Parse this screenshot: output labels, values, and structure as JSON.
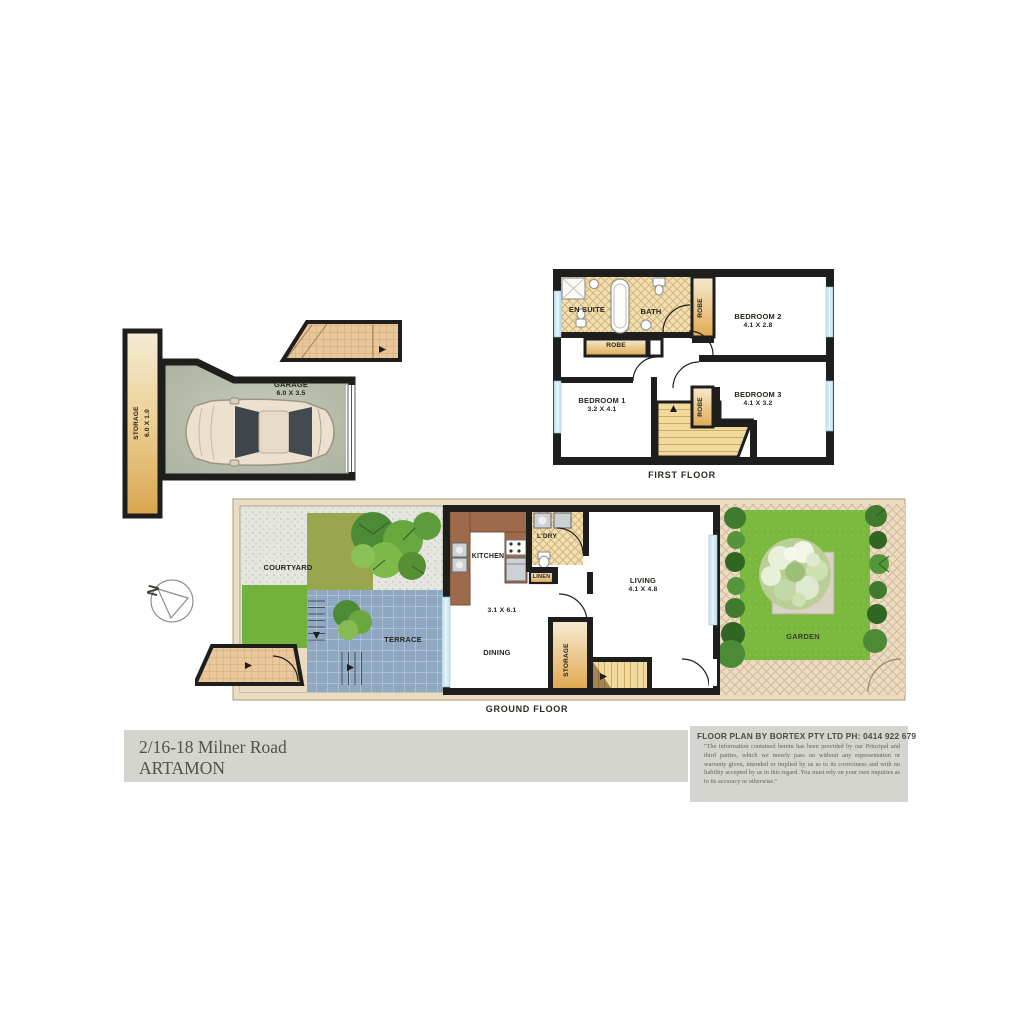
{
  "first_floor": {
    "caption": "FIRST FLOOR",
    "rooms": {
      "en_suite": {
        "label": "EN SUITE"
      },
      "bath": {
        "label": "BATH"
      },
      "robe_top": {
        "label": "ROBE"
      },
      "robe_hall": {
        "label": "ROBE"
      },
      "robe_mid": {
        "label": "ROBE"
      },
      "bedroom2": {
        "label": "BEDROOM 2",
        "dims": "4.1 X 2.8"
      },
      "bedroom1": {
        "label": "BEDROOM 1",
        "dims": "3.2 X 4.1"
      },
      "bedroom3": {
        "label": "BEDROOM 3",
        "dims": "4.1 X 3.2"
      }
    }
  },
  "garage_block": {
    "garage": {
      "label": "GARAGE",
      "dims": "6.0 X 3.5"
    },
    "storage": {
      "label": "STORAGE",
      "dims": "6.0 X 1.0"
    }
  },
  "ground_floor": {
    "caption": "GROUND FLOOR",
    "rooms": {
      "courtyard": {
        "label": "COURTYARD"
      },
      "terrace": {
        "label": "TERRACE"
      },
      "kitchen": {
        "label": "KITCHEN"
      },
      "laundry": {
        "label": "L'DRY"
      },
      "linen": {
        "label": "LINEN"
      },
      "dining": {
        "label": "DINING",
        "dims": "3.1 X 6.1"
      },
      "storage": {
        "label": "STORAGE"
      },
      "living": {
        "label": "LIVING",
        "dims": "4.1 X 4.8"
      },
      "garden": {
        "label": "GARDEN"
      }
    }
  },
  "compass": {
    "label": "N"
  },
  "footer": {
    "address_line1": "2/16-18 Milner Road",
    "address_line2": "ARTAMON",
    "credit": "FLOOR PLAN BY BORTEX PTY LTD PH: 0414 922 679",
    "disclaimer": "\"The information contained herein has been provided by our Principal and third parties, which we merely pass on without any representation or warranty given, intended or implied by us as to its correctness and with no liability accepted by us in this regard. You must rely on your own inquiries as to its accuracy or otherwise.\""
  },
  "colors": {
    "wall": "#1e1e1c",
    "tan": "#e4b765",
    "terrace_tile": "#8fa8c2",
    "lawn": "#7ab93e",
    "glass": "#cdeaf6",
    "bar_gray": "#d3d5ce"
  }
}
